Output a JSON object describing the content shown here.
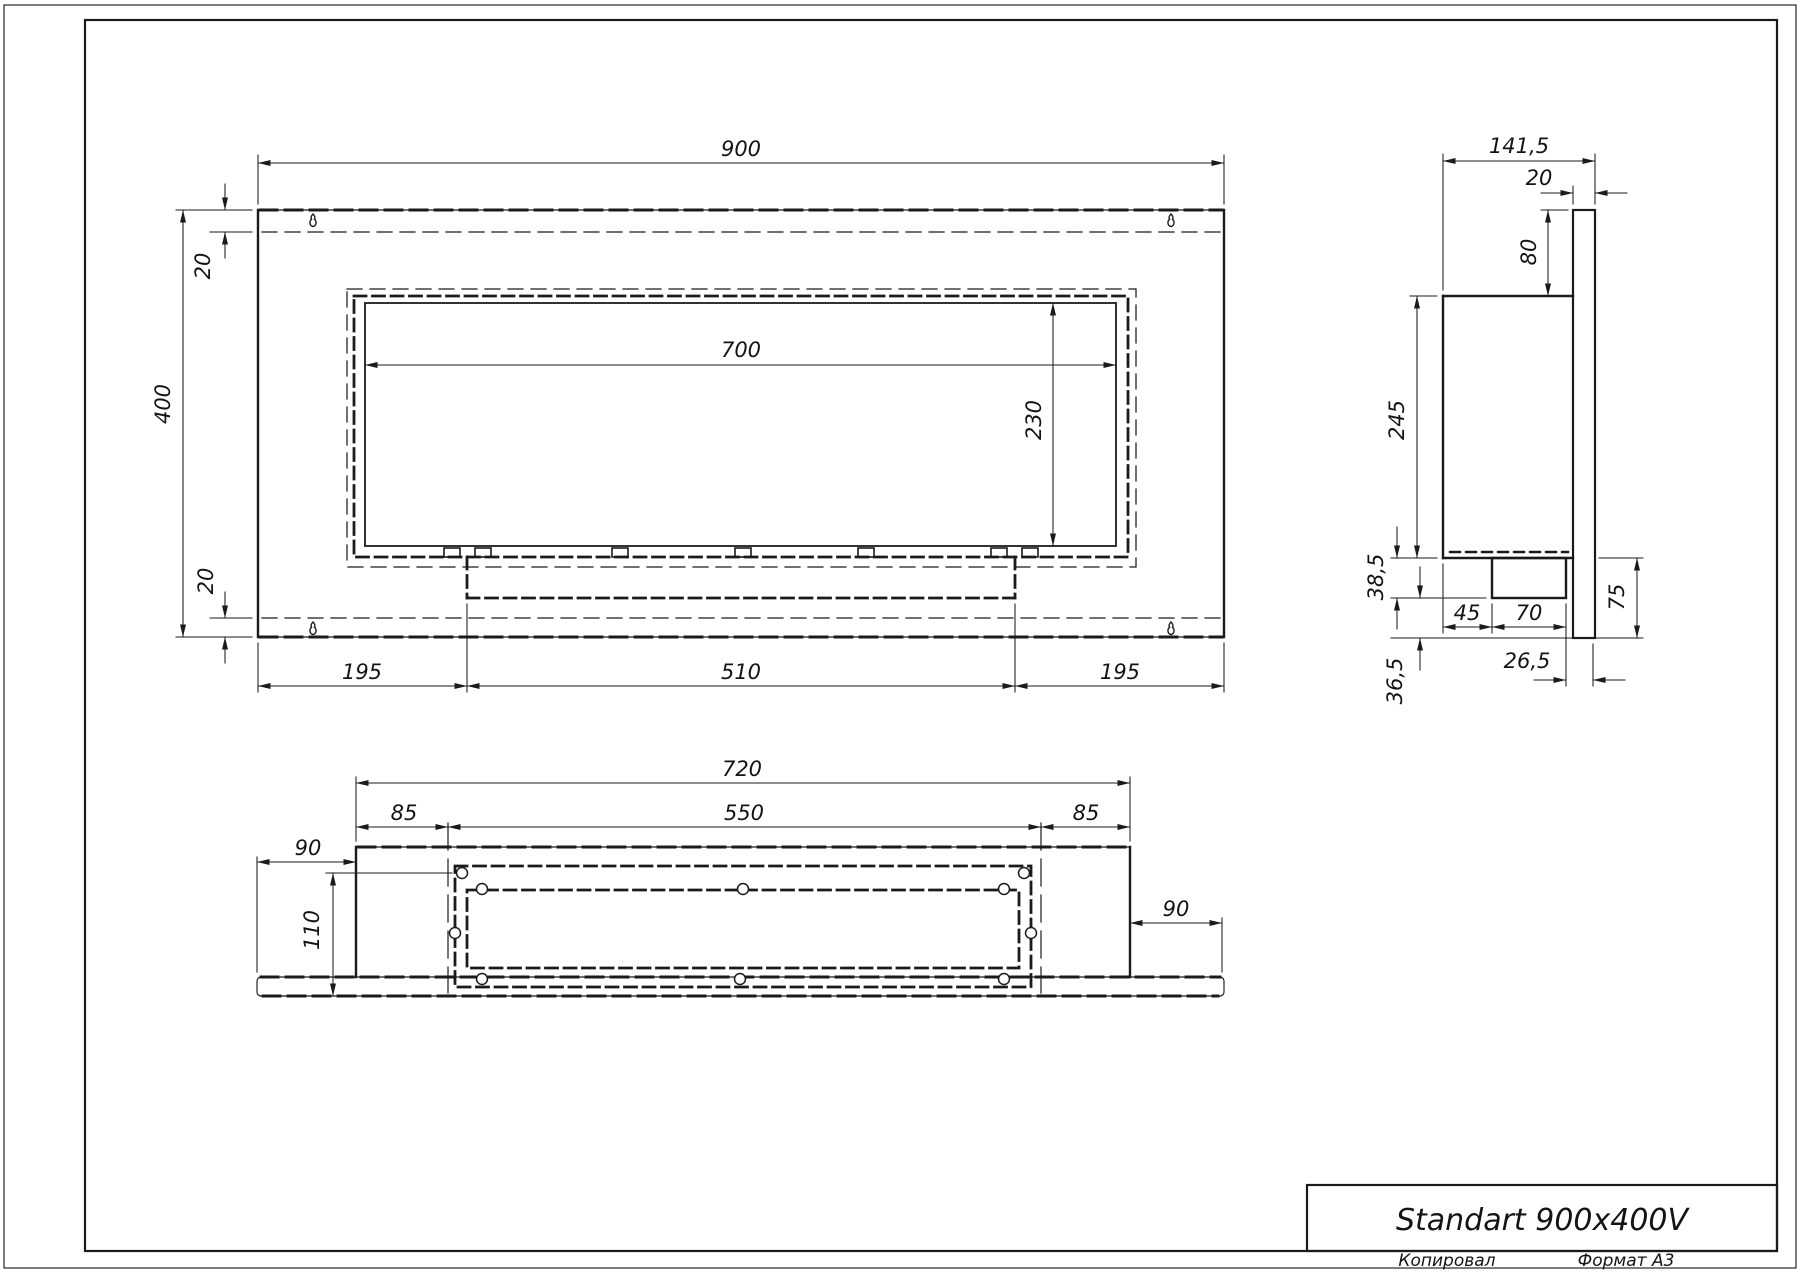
{
  "title_block": {
    "title": "Standart 900x400V"
  },
  "page": {
    "copied_label": "Копировал",
    "format_label": "Формат A3"
  },
  "front_view": {
    "dims": {
      "width": "900",
      "height": "400",
      "flange_top": "20",
      "flange_bottom": "20",
      "opening_width": "700",
      "opening_height": "230",
      "left_offset": "195",
      "tray_span": "510",
      "right_offset": "195"
    }
  },
  "side_view": {
    "dims": {
      "depth": "141,5",
      "plate_thickness": "20",
      "top_drop": "80",
      "body_height": "245",
      "tray_drop": "38,5",
      "below_tray": "36,5",
      "tray_offset": "45",
      "tray_depth": "70",
      "tray_to_plate": "26,5",
      "lower_height": "75"
    }
  },
  "bottom_view": {
    "dims": {
      "body_width": "720",
      "margin_left": "85",
      "opening_width": "550",
      "margin_right": "85",
      "plate_overhang_left": "90",
      "depth": "110",
      "plate_overhang_right": "90"
    }
  }
}
